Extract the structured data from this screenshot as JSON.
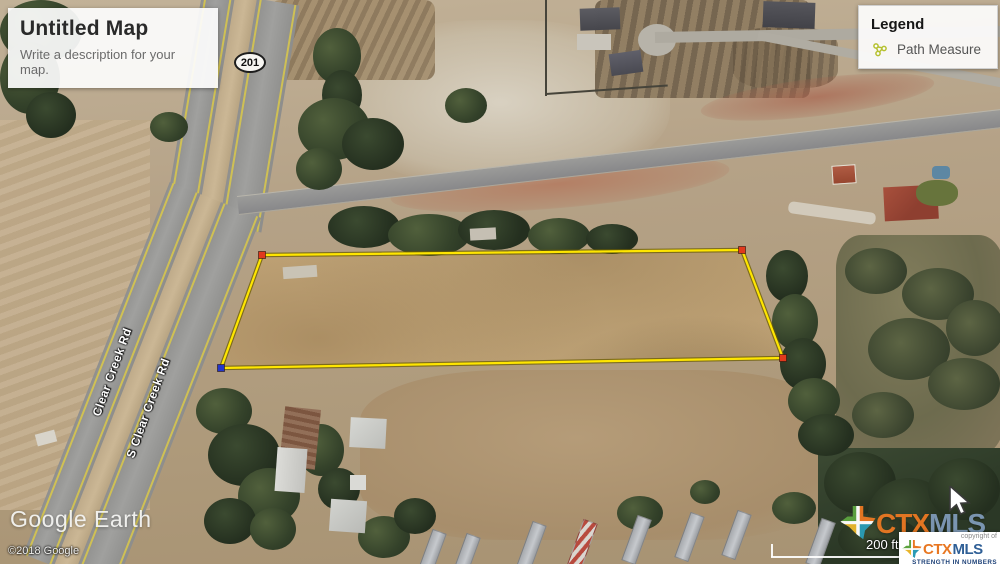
{
  "title_panel": {
    "title": "Untitled Map",
    "subtitle": "Write a description for your map."
  },
  "legend": {
    "title": "Legend",
    "items": [
      {
        "label": "Path Measure"
      }
    ],
    "icon_color": "#b5c02f"
  },
  "map_labels": {
    "route_shield": "201",
    "road_left": "Clear Creek Rd",
    "road_right": "S Clear Creek Rd"
  },
  "attribution": {
    "brand": "Google Earth",
    "copyright": "©2018 Google"
  },
  "scale_bar": {
    "label": "200 ft"
  },
  "watermark": {
    "ctx": "CTX",
    "mls": "MLS"
  },
  "brand_box": {
    "copyright_of": "copyright of",
    "ctx": "CTX",
    "mls": "MLS",
    "tagline": "STRENGTH IN NUMBERS"
  },
  "parcel": {
    "outline_color": "#ffe600",
    "outline_halo": "#6b5c00",
    "vertices": [
      [
        262,
        255
      ],
      [
        742,
        250
      ],
      [
        783,
        358
      ],
      [
        221,
        368
      ]
    ],
    "markers": [
      {
        "x": 262,
        "y": 255,
        "color": "#e0391d"
      },
      {
        "x": 742,
        "y": 250,
        "color": "#e0391d"
      },
      {
        "x": 783,
        "y": 358,
        "color": "#e0391d"
      },
      {
        "x": 221,
        "y": 368,
        "color": "#2336c9"
      }
    ]
  }
}
